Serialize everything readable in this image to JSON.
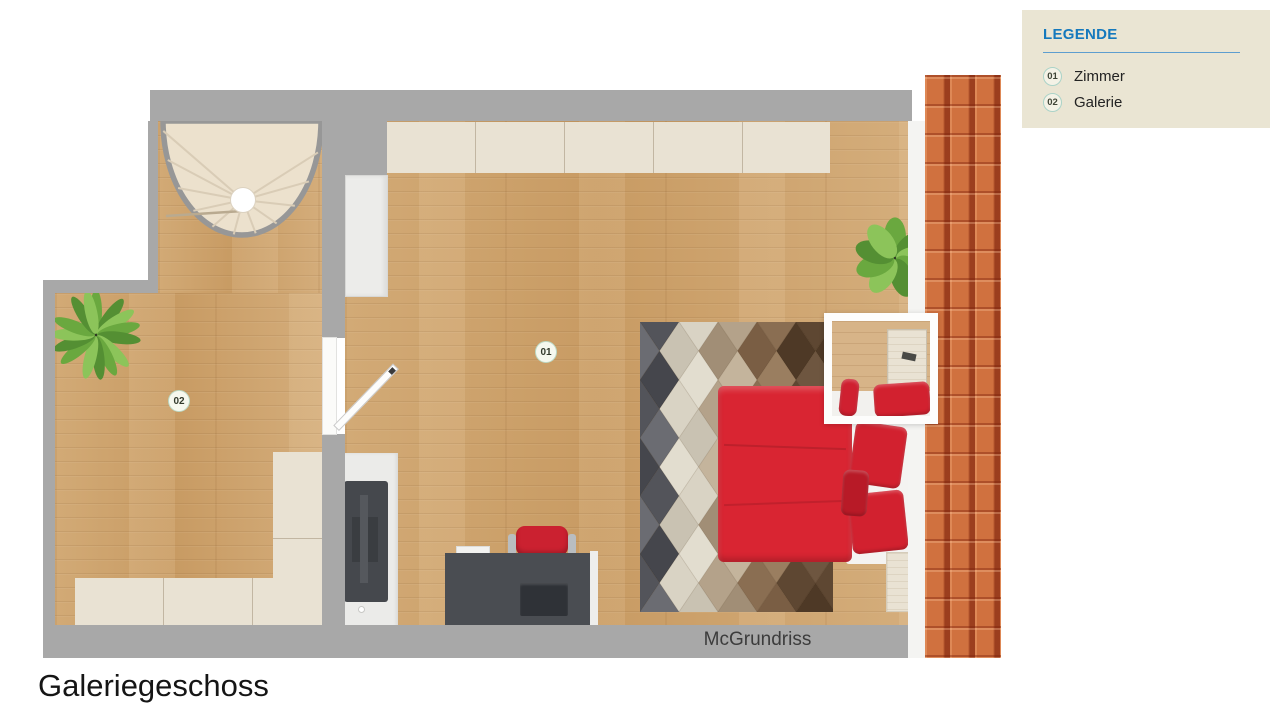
{
  "page_title": "Galeriegeschoss",
  "watermark": "McGrundriss",
  "legend": {
    "title": "LEGENDE",
    "items": [
      {
        "code": "01",
        "label": "Zimmer"
      },
      {
        "code": "02",
        "label": "Galerie"
      }
    ]
  },
  "plan_badges": [
    {
      "code": "01"
    },
    {
      "code": "02"
    }
  ],
  "colors": {
    "legend_bg": "#eae5d3",
    "legend_accent": "#1579bd",
    "legend_divider": "#5e9ecf",
    "wall_gray": "#a8a8a8",
    "floor_wood": "#cfa571",
    "whitewash_wood": "#e9e2d3",
    "roof_tile": "#d0713f",
    "roof_tile_groove": "#7b1f0a",
    "bed_red": "#d92532",
    "pillow_red": "#d2212f",
    "chair_red": "#cb2130",
    "desk_gray": "#4a4d52",
    "tv_gray": "#45484d",
    "stair_tread": "#ece1cd"
  },
  "decor": {
    "rug_columns": [
      [
        "#53545a",
        "#6b6c72",
        "#45464c"
      ],
      [
        "#d9d3c4",
        "#c9c2b2",
        "#e2ddcf"
      ],
      [
        "#b4a28a",
        "#a18e76",
        "#c4b49c"
      ],
      [
        "#8a6e52",
        "#7a5e44",
        "#9a7e60"
      ],
      [
        "#5e4732",
        "#4e3926",
        "#6e5640"
      ]
    ],
    "plant_greens": [
      "#6aa83f",
      "#548f33",
      "#8cc45a"
    ],
    "pot": "#2e3823",
    "stair_ray": "#d9ccb6"
  }
}
